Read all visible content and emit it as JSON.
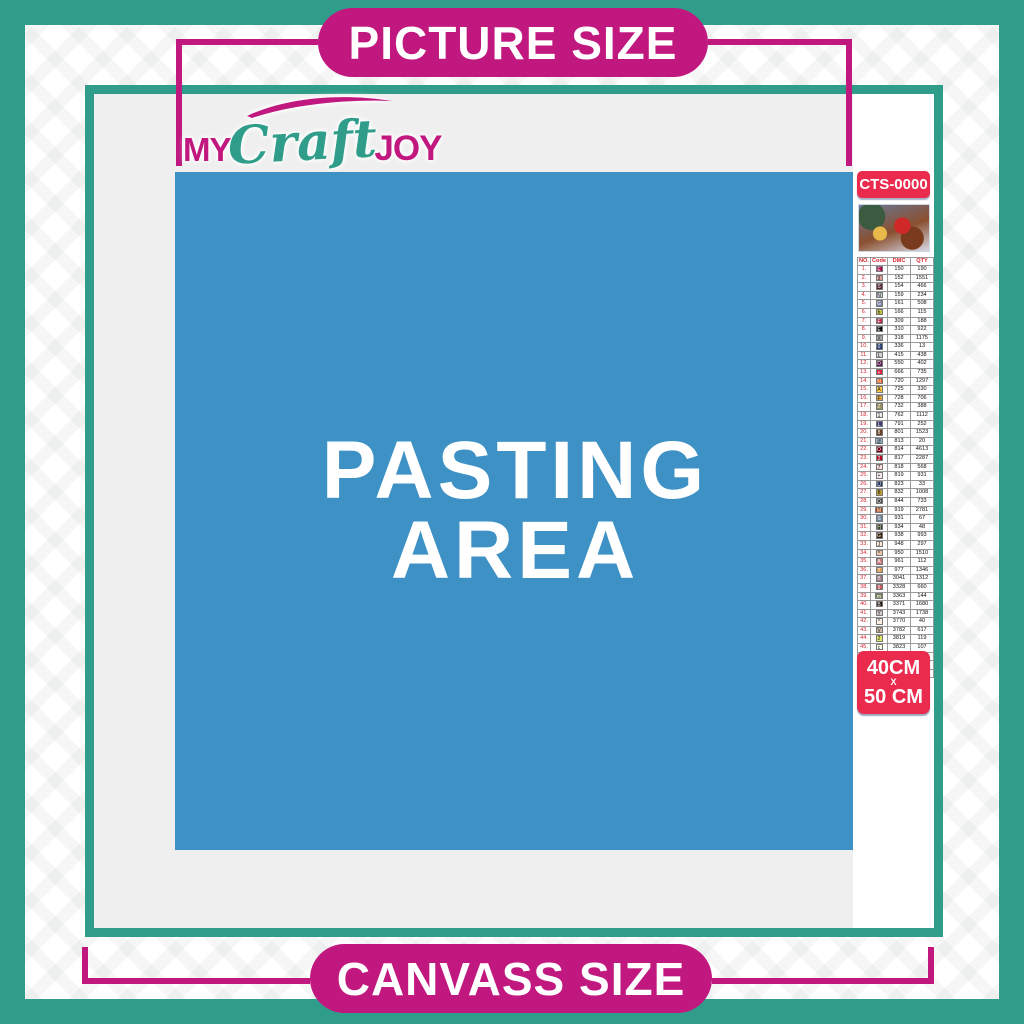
{
  "banners": {
    "top": "PICTURE SIZE",
    "bottom": "CANVASS SIZE"
  },
  "logo": {
    "part1": "MY",
    "part2": "Craft",
    "part3": "JOY"
  },
  "pasting_area": {
    "line1": "PASTING",
    "line2": "AREA"
  },
  "sidebar": {
    "sku": "CTS-0000",
    "thumbnail": "santa-sleigh-christmas-artwork",
    "size_badge": {
      "line1": "40CM",
      "line2": "X",
      "line3": "50 CM"
    },
    "table": {
      "headers": [
        "NO.",
        "Code",
        "DMC",
        "QTY"
      ],
      "rows": [
        {
          "no": "1.",
          "code": "E",
          "dmc": "150",
          "qty": "190",
          "bg": "#AB0249",
          "fg": "#FFFFFF"
        },
        {
          "no": "2.",
          "code": "3",
          "dmc": "152",
          "qty": "1551",
          "bg": "#E2A099",
          "fg": "#222222"
        },
        {
          "no": "3.",
          "code": "S",
          "dmc": "154",
          "qty": "466",
          "bg": "#572433",
          "fg": "#FFFFFF"
        },
        {
          "no": "4.",
          "code": "N",
          "dmc": "159",
          "qty": "234",
          "bg": "#C7CAD7",
          "fg": "#222222"
        },
        {
          "no": "5.",
          "code": "G",
          "dmc": "161",
          "qty": "508",
          "bg": "#7880A4",
          "fg": "#FFFFFF"
        },
        {
          "no": "6.",
          "code": "h",
          "dmc": "166",
          "qty": "115",
          "bg": "#C0C840",
          "fg": "#222222"
        },
        {
          "no": "7.",
          "code": "F",
          "dmc": "309",
          "qty": "188",
          "bg": "#BA2B4E",
          "fg": "#FFFFFF"
        },
        {
          "no": "8.",
          "code": "E",
          "dmc": "310",
          "qty": "922",
          "bg": "#000000",
          "fg": "#FFFFFF"
        },
        {
          "no": "9.",
          "code": "X",
          "dmc": "318",
          "qty": "1175",
          "bg": "#ABABAB",
          "fg": "#222222"
        },
        {
          "no": "10.",
          "code": "0",
          "dmc": "336",
          "qty": "13",
          "bg": "#253B73",
          "fg": "#FFFFFF"
        },
        {
          "no": "11.",
          "code": "L",
          "dmc": "415",
          "qty": "438",
          "bg": "#D3D3DB",
          "fg": "#222222"
        },
        {
          "no": "12.",
          "code": "D",
          "dmc": "550",
          "qty": "402",
          "bg": "#5C184E",
          "fg": "#FFFFFF"
        },
        {
          "no": "13.",
          "code": "+",
          "dmc": "666",
          "qty": "735",
          "bg": "#E31D42",
          "fg": "#FFFFFF"
        },
        {
          "no": "14.",
          "code": "N",
          "dmc": "720",
          "qty": "1297",
          "bg": "#E55C1F",
          "fg": "#FFFFFF"
        },
        {
          "no": "15.",
          "code": "A",
          "dmc": "725",
          "qty": "330",
          "bg": "#FFC840",
          "fg": "#222222"
        },
        {
          "no": "16.",
          "code": "F",
          "dmc": "728",
          "qty": "706",
          "bg": "#E4A33C",
          "fg": "#222222"
        },
        {
          "no": "17.",
          "code": "Z",
          "dmc": "732",
          "qty": "388",
          "bg": "#948C54",
          "fg": "#FFFFFF"
        },
        {
          "no": "18.",
          "code": "1",
          "dmc": "762",
          "qty": "1112",
          "bg": "#ECECEC",
          "fg": "#222222"
        },
        {
          "no": "19.",
          "code": "L",
          "dmc": "791",
          "qty": "252",
          "bg": "#3B3F75",
          "fg": "#FFFFFF"
        },
        {
          "no": "20.",
          "code": "8",
          "dmc": "801",
          "qty": "1523",
          "bg": "#653919",
          "fg": "#FFFFFF"
        },
        {
          "no": "21.",
          "code": "@",
          "dmc": "813",
          "qty": "20",
          "bg": "#A1C2D7",
          "fg": "#222222"
        },
        {
          "no": "22.",
          "code": "O",
          "dmc": "814",
          "qty": "4613",
          "bg": "#7B001B",
          "fg": "#FFFFFF"
        },
        {
          "no": "23.",
          "code": "2",
          "dmc": "817",
          "qty": "2287",
          "bg": "#BB051F",
          "fg": "#FFFFFF"
        },
        {
          "no": "24.",
          "code": "7",
          "dmc": "818",
          "qty": "568",
          "bg": "#FFDFD9",
          "fg": "#222222"
        },
        {
          "no": "25.",
          "code": "+",
          "dmc": "819",
          "qty": "931",
          "bg": "#F8E8E7",
          "fg": "#222222"
        },
        {
          "no": "26.",
          "code": "U",
          "dmc": "823",
          "qty": "33",
          "bg": "#213063",
          "fg": "#FFFFFF"
        },
        {
          "no": "27.",
          "code": "8",
          "dmc": "832",
          "qty": "1008",
          "bg": "#BD9B33",
          "fg": "#222222"
        },
        {
          "no": "28.",
          "code": "O",
          "dmc": "844",
          "qty": "733",
          "bg": "#484848",
          "fg": "#FFFFFF"
        },
        {
          "no": "29.",
          "code": "M",
          "dmc": "919",
          "qty": "2781",
          "bg": "#A64510",
          "fg": "#FFFFFF"
        },
        {
          "no": "30.",
          "code": "S",
          "dmc": "931",
          "qty": "67",
          "bg": "#6A859E",
          "fg": "#FFFFFF"
        },
        {
          "no": "31.",
          "code": "H",
          "dmc": "934",
          "qty": "48",
          "bg": "#313919",
          "fg": "#FFFFFF"
        },
        {
          "no": "32.",
          "code": "G",
          "dmc": "938",
          "qty": "993",
          "bg": "#36220C",
          "fg": "#FFFFFF"
        },
        {
          "no": "33.",
          "code": "J",
          "dmc": "948",
          "qty": "297",
          "bg": "#FEE7DA",
          "fg": "#222222"
        },
        {
          "no": "34.",
          "code": "*",
          "dmc": "950",
          "qty": "1510",
          "bg": "#E8C4A9",
          "fg": "#222222"
        },
        {
          "no": "35.",
          "code": "A",
          "dmc": "961",
          "qty": "112",
          "bg": "#CF7479",
          "fg": "#FFFFFF"
        },
        {
          "no": "36.",
          "code": "T",
          "dmc": "977",
          "qty": "1346",
          "bg": "#DC9C56",
          "fg": "#FFFFFF"
        },
        {
          "no": "37.",
          "code": "B",
          "dmc": "3041",
          "qty": "1312",
          "bg": "#956F7C",
          "fg": "#FFFFFF"
        },
        {
          "no": "38.",
          "code": "9",
          "dmc": "3328",
          "qty": "660",
          "bg": "#C54F57",
          "fg": "#FFFFFF"
        },
        {
          "no": "39.",
          "code": "m",
          "dmc": "3363",
          "qty": "144",
          "bg": "#728256",
          "fg": "#FFFFFF"
        },
        {
          "no": "40.",
          "code": "B",
          "dmc": "3371",
          "qty": "1680",
          "bg": "#1E1108",
          "fg": "#FFFFFF"
        },
        {
          "no": "41.",
          "code": "Y",
          "dmc": "3743",
          "qty": "1738",
          "bg": "#D7CBD3",
          "fg": "#222222"
        },
        {
          "no": "42.",
          "code": "^",
          "dmc": "3770",
          "qty": "40",
          "bg": "#FFEEE3",
          "fg": "#222222"
        },
        {
          "no": "43.",
          "code": "V",
          "dmc": "3782",
          "qty": "617",
          "bg": "#D2BCA6",
          "fg": "#222222"
        },
        {
          "no": "44.",
          "code": "2",
          "dmc": "3819",
          "qty": "119",
          "bg": "#E0E868",
          "fg": "#222222"
        },
        {
          "no": "45.",
          "code": "c",
          "dmc": "3823",
          "qty": "107",
          "bg": "#FFFDE3",
          "fg": "#222222"
        },
        {
          "no": "46.",
          "code": "C",
          "dmc": "3853",
          "qty": "1332",
          "bg": "#F29746",
          "fg": "#FFFFFF"
        },
        {
          "no": "47.",
          "code": "L",
          "dmc": "3858",
          "qty": "2311",
          "bg": "#964A4A",
          "fg": "#FFFFFF"
        },
        {
          "no": "48.",
          "code": "A",
          "dmc": "3863",
          "qty": "1820",
          "bg": "#A4835C",
          "fg": "#FFFFFF"
        }
      ]
    }
  },
  "colors": {
    "teal": "#2F9D8A",
    "magenta": "#C1187F",
    "badge_red": "#EA2B4E",
    "pasting_blue": "#3E91C5",
    "interior_gray": "#EFEFEF"
  }
}
